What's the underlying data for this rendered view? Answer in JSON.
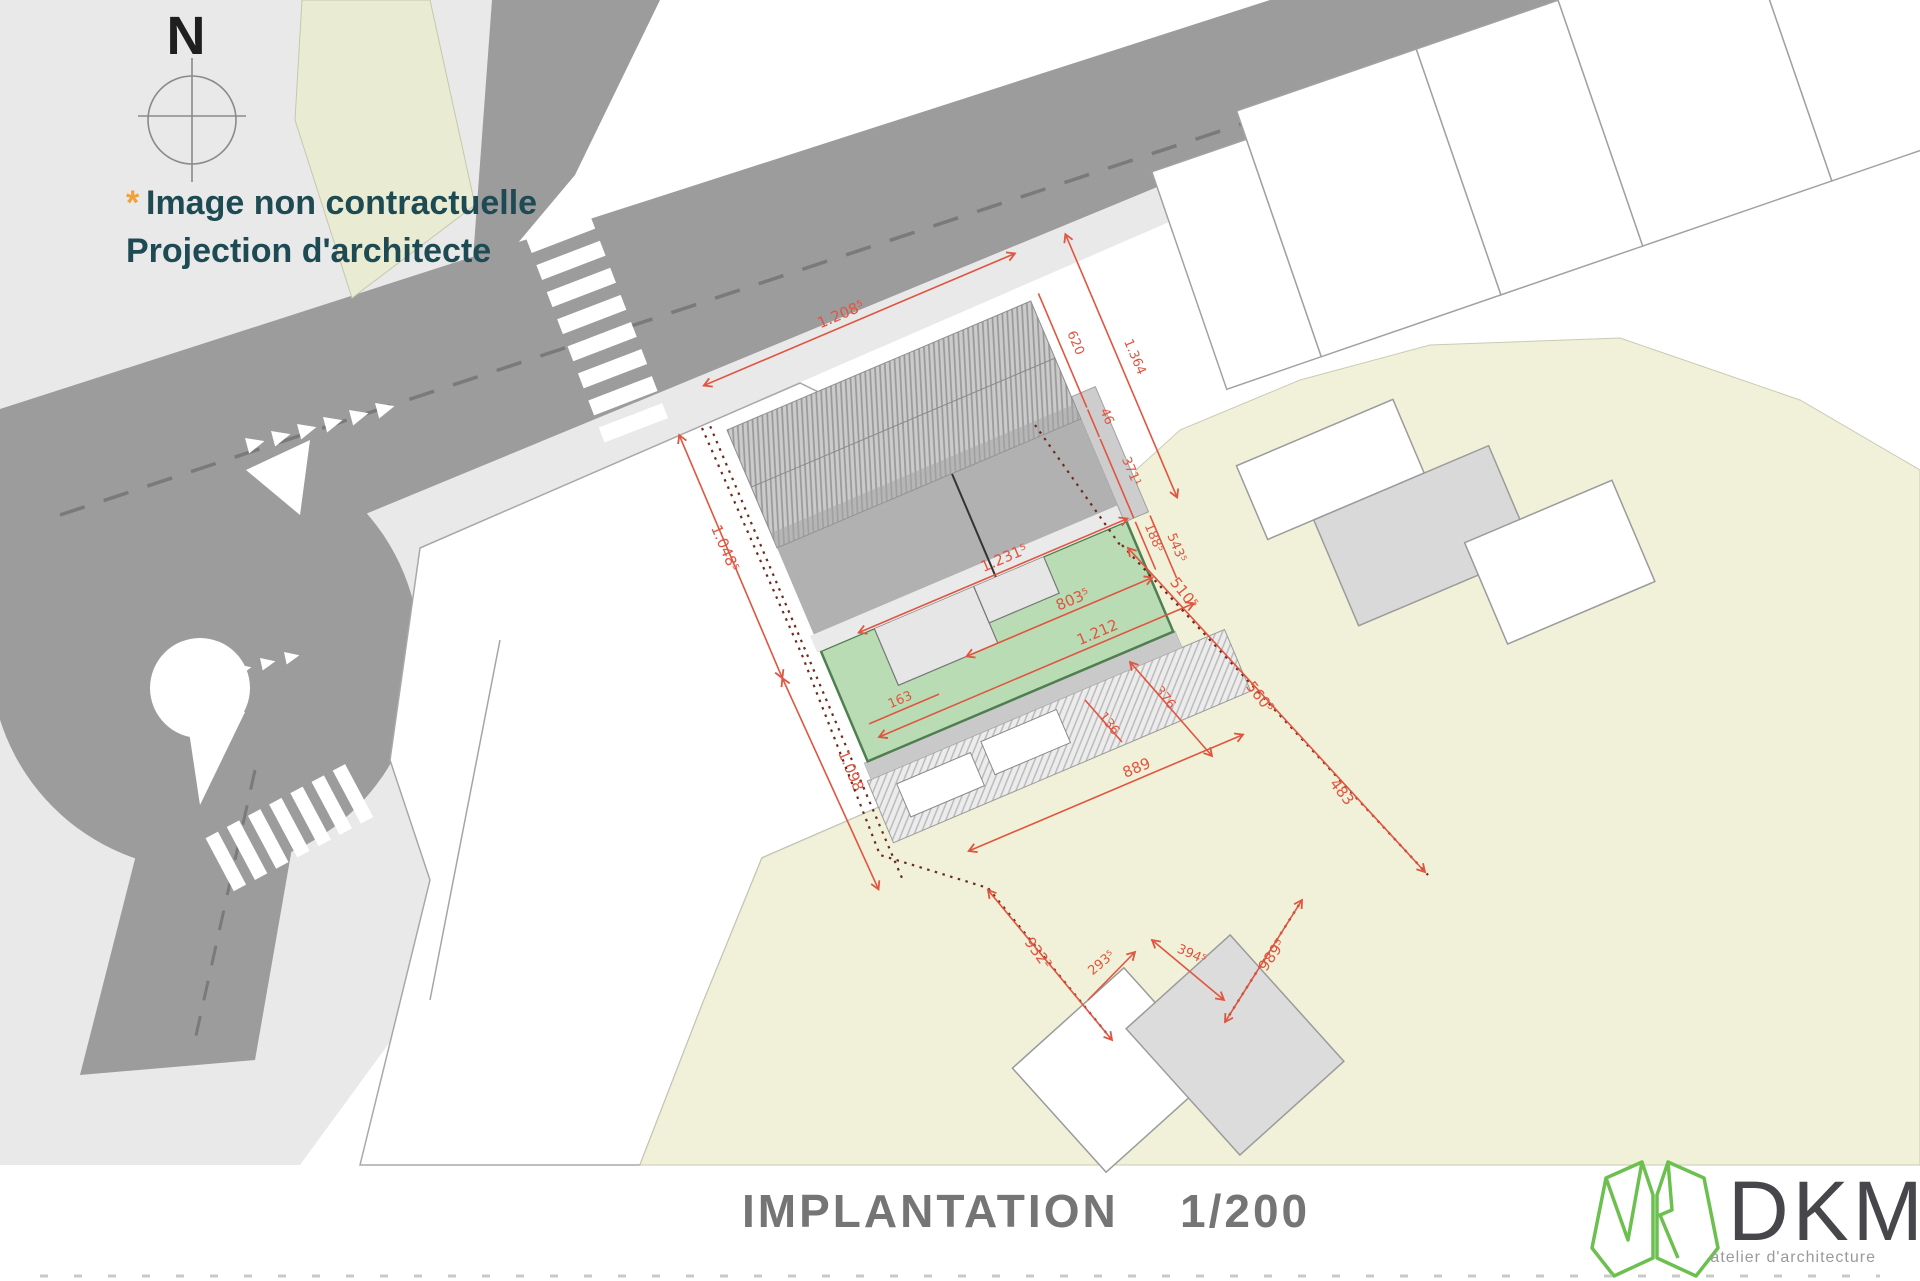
{
  "plan": {
    "compass_label": "N",
    "disclaimer": {
      "asterisk": "*",
      "line1": "Image non contractuelle",
      "line2": "Projection d'architecte"
    },
    "title": {
      "label": "IMPLANTATION",
      "scale": "1/200"
    },
    "logo": {
      "wordmark": "DKM",
      "subtitle": "atelier d'architecture"
    },
    "colors": {
      "dimension_red": "#e05540",
      "boundary_brown": "#6e2a1c",
      "garden_green": "#b9dcb4",
      "garden_green_outline": "#4f7f50",
      "road_gray": "#9c9c9c",
      "sidewalk_gray": "#e9e9e9",
      "parcel_yellow": "#f0f1d8",
      "olive_parcel": "#e9ecd2",
      "note_teal": "#1d4a53",
      "asterisk_orange": "#f0a13a",
      "logo_green": "#6cc04f",
      "title_gray": "#757575"
    },
    "dimensions": {
      "d1208": "1.208⁵",
      "d620": "620",
      "d46": "46",
      "d371": "371¹",
      "d1364": "1.364",
      "d1048": "1.048⁵",
      "d1231": "1.231⁵",
      "d188": "188⁵",
      "d543": "543⁵",
      "d803": "803⁵",
      "d163": "163",
      "d1212": "1.212",
      "d510": "510⁵",
      "d560": "560⁵",
      "d376": "376",
      "d136": "136",
      "d483": "483",
      "d889": "889",
      "d1098": "1.098",
      "d932": "932²",
      "d293": "293⁵",
      "d394": "394⁵",
      "d989": "989⁵"
    }
  }
}
